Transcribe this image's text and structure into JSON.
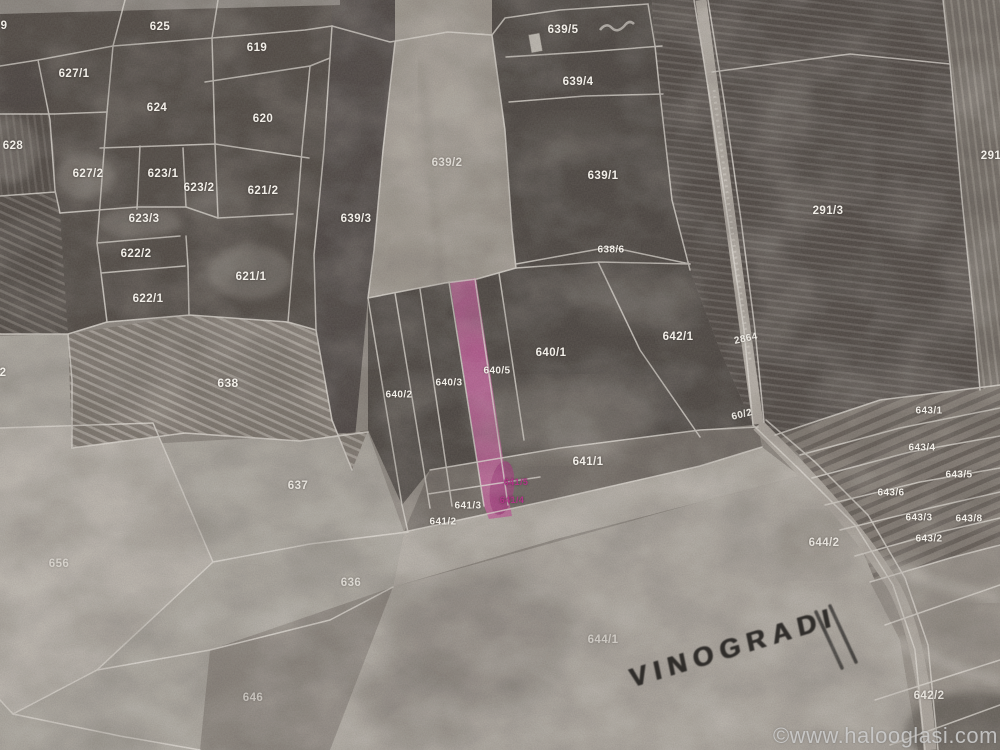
{
  "map": {
    "watermark": "©www.halooglasi.com",
    "handwriting": "VINOGRADI",
    "highlight_color": "#c5589c",
    "pink_label_color": "#b23488",
    "line_color": "#ece8e2",
    "label_color": "#f2efe9",
    "parcels": [
      {
        "label": "9",
        "x": 4,
        "y": 26
      },
      {
        "label": "625",
        "x": 160,
        "y": 27
      },
      {
        "label": "619",
        "x": 257,
        "y": 48
      },
      {
        "label": "627/1",
        "x": 74,
        "y": 74
      },
      {
        "label": "624",
        "x": 157,
        "y": 108
      },
      {
        "label": "620",
        "x": 263,
        "y": 119
      },
      {
        "label": "628",
        "x": 13,
        "y": 146
      },
      {
        "label": "627/2",
        "x": 88,
        "y": 174
      },
      {
        "label": "623/1",
        "x": 163,
        "y": 174
      },
      {
        "label": "623/2",
        "x": 199,
        "y": 188
      },
      {
        "label": "621/2",
        "x": 263,
        "y": 191
      },
      {
        "label": "623/3",
        "x": 144,
        "y": 219
      },
      {
        "label": "622/2",
        "x": 136,
        "y": 254
      },
      {
        "label": "621/1",
        "x": 251,
        "y": 277
      },
      {
        "label": "622/1",
        "x": 148,
        "y": 299
      },
      {
        "label": "638",
        "x": 228,
        "y": 383,
        "size": 12
      },
      {
        "label": "2",
        "x": 3,
        "y": 373
      },
      {
        "label": "639/3",
        "x": 356,
        "y": 219
      },
      {
        "label": "639/2",
        "x": 447,
        "y": 163,
        "opacity": 0.75
      },
      {
        "label": "639/5",
        "x": 563,
        "y": 30
      },
      {
        "label": "639/4",
        "x": 578,
        "y": 82
      },
      {
        "label": "639/1",
        "x": 603,
        "y": 176
      },
      {
        "label": "638/6",
        "x": 611,
        "y": 250,
        "size": 10
      },
      {
        "label": "291/3",
        "x": 828,
        "y": 211
      },
      {
        "label": "291",
        "x": 991,
        "y": 156
      },
      {
        "label": "2864",
        "x": 746,
        "y": 339,
        "rot": -12,
        "size": 10
      },
      {
        "label": "642/1",
        "x": 678,
        "y": 337
      },
      {
        "label": "640/1",
        "x": 551,
        "y": 353
      },
      {
        "label": "640/5",
        "x": 497,
        "y": 371,
        "size": 10
      },
      {
        "label": "640/3",
        "x": 449,
        "y": 383,
        "size": 10
      },
      {
        "label": "640/2",
        "x": 399,
        "y": 395,
        "size": 10
      },
      {
        "label": "60/2",
        "x": 742,
        "y": 415,
        "rot": -14,
        "size": 10
      },
      {
        "label": "641/1",
        "x": 588,
        "y": 462
      },
      {
        "label": "641/5",
        "x": 516,
        "y": 482,
        "size": 9,
        "color": "#b23488"
      },
      {
        "label": "641/4",
        "x": 512,
        "y": 500,
        "size": 9,
        "color": "#b23488"
      },
      {
        "label": "641/3",
        "x": 468,
        "y": 506,
        "size": 10
      },
      {
        "label": "641/2",
        "x": 443,
        "y": 522,
        "size": 10
      },
      {
        "label": "643/1",
        "x": 929,
        "y": 411,
        "size": 10
      },
      {
        "label": "643/4",
        "x": 922,
        "y": 448,
        "size": 10
      },
      {
        "label": "643/5",
        "x": 959,
        "y": 475,
        "size": 10
      },
      {
        "label": "643/6",
        "x": 891,
        "y": 493,
        "size": 10
      },
      {
        "label": "643/3",
        "x": 919,
        "y": 518,
        "size": 10
      },
      {
        "label": "643/8",
        "x": 969,
        "y": 519,
        "size": 10
      },
      {
        "label": "643/2",
        "x": 929,
        "y": 539,
        "size": 10
      },
      {
        "label": "644/2",
        "x": 824,
        "y": 543,
        "opacity": 0.85
      },
      {
        "label": "637",
        "x": 298,
        "y": 486,
        "opacity": 0.85
      },
      {
        "label": "656",
        "x": 59,
        "y": 564,
        "opacity": 0.55
      },
      {
        "label": "636",
        "x": 351,
        "y": 583,
        "opacity": 0.7
      },
      {
        "label": "644/1",
        "x": 603,
        "y": 640,
        "opacity": 0.55
      },
      {
        "label": "646",
        "x": 253,
        "y": 698,
        "opacity": 0.55
      },
      {
        "label": "642/2",
        "x": 929,
        "y": 696,
        "opacity": 0.85
      }
    ]
  }
}
